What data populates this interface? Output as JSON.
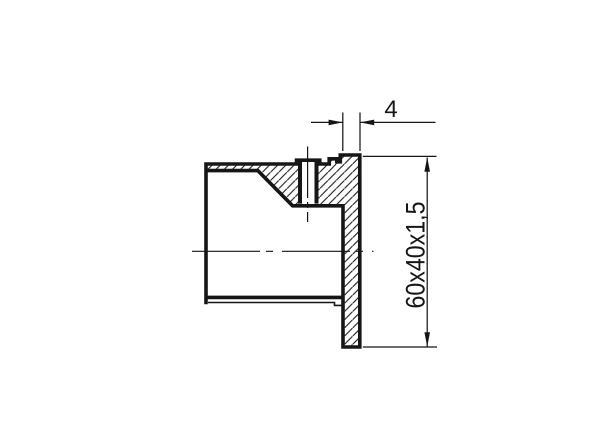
{
  "canvas": {
    "background": "#ffffff",
    "line_color": "#161616",
    "kind": "technical-section-drawing"
  },
  "dimensions": {
    "flange_thickness": {
      "label": "4"
    },
    "tube_size": {
      "label": "60x40x1,5"
    }
  }
}
